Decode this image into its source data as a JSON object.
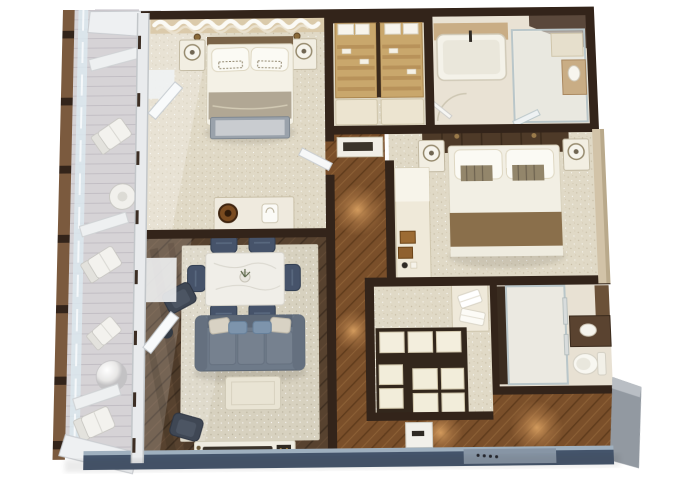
{
  "scene": {
    "kind": "3d-floorplan-isometric-render",
    "background": "#ffffff",
    "balcony_side": "left",
    "entry_side": "bottom-right"
  },
  "palette": {
    "wall": "#33241a",
    "wallWarm": "#4a3423",
    "carpet": "#e0d9c6",
    "rug": "#d7d1bf",
    "woodDark": "#57422f",
    "woodWarm": "#7a4f2a",
    "deck": "#d6d3d6",
    "glassRail": "#dce7ee",
    "frameWhite": "#e9ebed",
    "white": "#f2f1ec",
    "cream": "#efe9d9",
    "creamDark": "#e2d9c3",
    "sofa": "#6e7a89",
    "sofaDark": "#5d6877",
    "chairSlate": "#46536a",
    "accentChair": "#3f4754",
    "navy": "#44546b",
    "navyLight": "#9fb0bf",
    "doorBlue": "#8795a5",
    "tanWood": "#c9a76c",
    "tanDeck": "#c9ad85",
    "throw": "#8a6f4b",
    "benchGray": "#9aa2ab",
    "glow": "#e8a963",
    "beigeWall": "#d2c3a8",
    "grayWall": "#9299a1",
    "headboard": "#4e3a28",
    "tray": "#9c6b33"
  },
  "rooms": [
    {
      "id": "balcony",
      "name": "Balcony",
      "floor": "light-gray-deck",
      "furniture": [
        "lounge-chair",
        "lounge-chair",
        "lounge-chair",
        "lounge-chair",
        "round-side-table",
        "sphere-side-table",
        "privacy-partition",
        "privacy-partition",
        "privacy-partition",
        "glass-railing"
      ]
    },
    {
      "id": "master-bedroom",
      "name": "Master Bedroom",
      "floor": "beige-carpet",
      "furniture": [
        "king-bed",
        "pillows",
        "foot-bench",
        "nightstand",
        "nightstand",
        "table-lamp",
        "table-lamp",
        "wall-sconce",
        "wall-sconce",
        "dresser-console",
        "console-lamp",
        "ice-bucket",
        "valance-curtain"
      ]
    },
    {
      "id": "walk-in-closet",
      "name": "Walk-in Closet",
      "floor": "beige-carpet",
      "furniture": [
        "shelving-unit",
        "linen-boxes",
        "slatted-shelves",
        "bench-cushions"
      ]
    },
    {
      "id": "master-bathroom",
      "name": "Master Bathroom",
      "floor": "stone-beige",
      "furniture": [
        "bathtub",
        "walk-in-shower",
        "shower-bench",
        "vanity",
        "door-swing"
      ]
    },
    {
      "id": "bedroom-2",
      "name": "Bedroom 2",
      "floor": "beige-carpet",
      "furniture": [
        "queen-bed",
        "dark-headboard",
        "pillows",
        "foot-throw",
        "nightstand",
        "nightstand",
        "table-lamp",
        "table-lamp",
        "minibar-counter",
        "serving-trays",
        "credenza"
      ]
    },
    {
      "id": "hallway",
      "name": "Hallway",
      "floor": "warm-oak-plank",
      "furniture": [
        "ceiling-light-glow"
      ]
    },
    {
      "id": "dressing-area",
      "name": "Dressing Area",
      "floor": "beige-carpet",
      "furniture": [
        "towel-counter",
        "folded-towels",
        "drawer-bank",
        "drawer-bank"
      ]
    },
    {
      "id": "bathroom-2",
      "name": "Bathroom 2",
      "floor": "stone-beige",
      "furniture": [
        "walk-in-shower",
        "towel-bars",
        "toilet",
        "vanity-sink"
      ]
    },
    {
      "id": "foyer",
      "name": "Entry Foyer",
      "floor": "warm-oak-plank",
      "furniture": [
        "entry-door",
        "console-table",
        "ceiling-light-glow",
        "ceiling-light-glow"
      ]
    },
    {
      "id": "living-dining",
      "name": "Living & Dining Room",
      "floor": "dark-walnut-plank",
      "furniture": [
        "area-rug",
        "dining-table",
        "dining-chair",
        "dining-chair",
        "dining-chair",
        "dining-chair",
        "dining-chair",
        "dining-chair",
        "centerpiece-plant",
        "sofa",
        "throw-pillows",
        "coffee-table",
        "accent-chair",
        "accent-chair",
        "side-table",
        "media-console"
      ]
    }
  ]
}
